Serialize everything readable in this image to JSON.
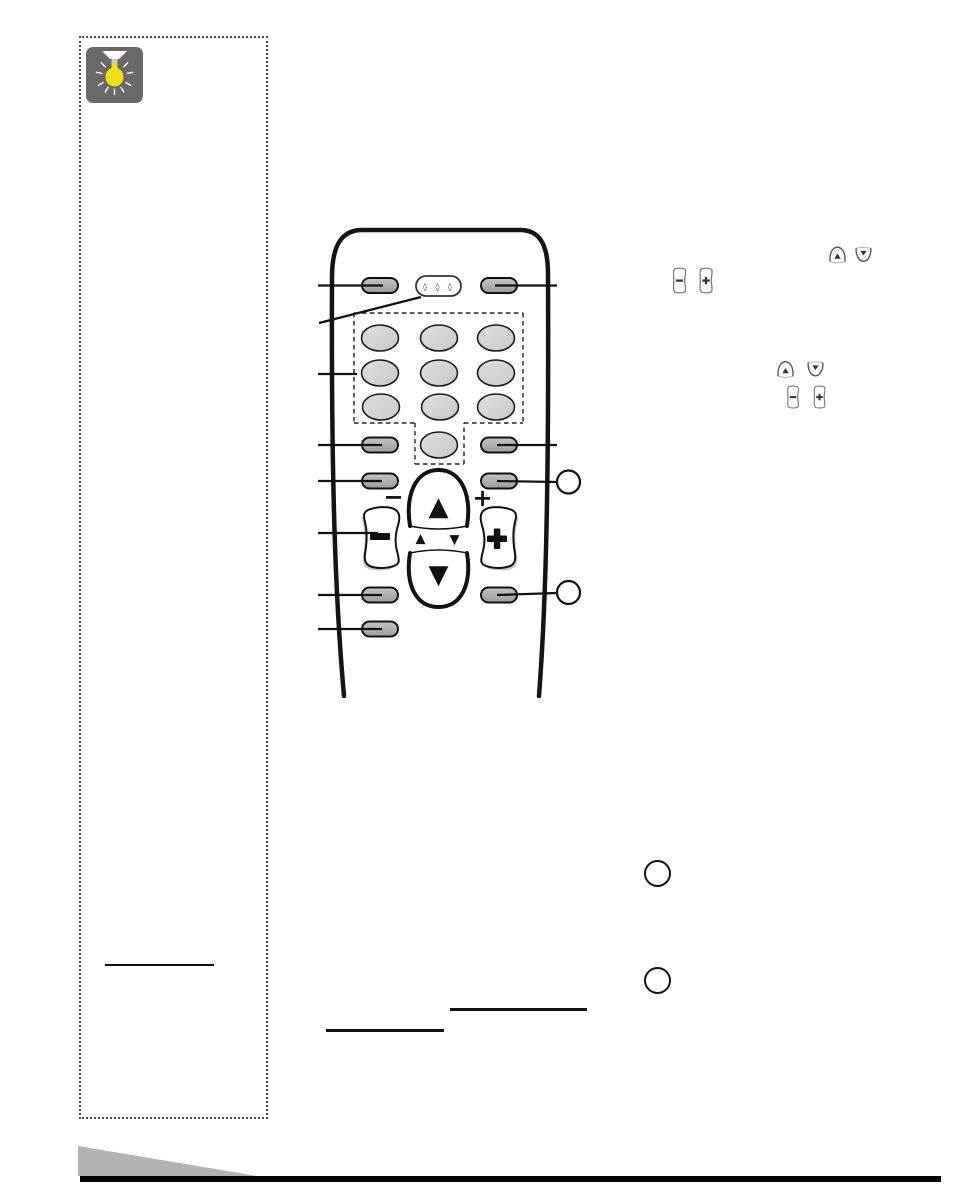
{
  "page": {
    "background_color": "#ffffff",
    "footer_bar_color": "#000000",
    "footer_triangle_color": "#b3b3b3"
  },
  "tip_sidebar": {
    "icon": "lightbulb-icon",
    "icon_background_color": "#696969",
    "bulb_color": "#f2e011",
    "has_divider_rule": true
  },
  "remote_diagram": {
    "display_dots_glyph": "◊ ◊ ◊",
    "volume_minus_hint": "−",
    "volume_plus_hint": "+",
    "minus_glyph": "−",
    "plus_glyph": "+",
    "channel_up_glyph": "▲",
    "channel_down_glyph": "▼",
    "small_up_glyph": "▲",
    "small_down_glyph": "▼",
    "keypad_button_count": 10,
    "left_side_button_count": 6,
    "right_side_button_count": 4,
    "callout_circle_count": 2,
    "body_outline_color": "#141414",
    "side_button_fill": "#b0b0b0",
    "keypad_button_fill": "#d6d6d6"
  },
  "inline_icons": {
    "group_1": [
      "channel-up-mini-icon",
      "channel-down-mini-icon"
    ],
    "group_2": [
      "volume-minus-mini-icon",
      "volume-plus-mini-icon"
    ],
    "group_3": [
      "channel-up-mini-icon",
      "channel-down-mini-icon"
    ],
    "group_4": [
      "volume-minus-mini-icon",
      "volume-plus-mini-icon"
    ],
    "minus_glyph": "−",
    "plus_glyph": "+"
  },
  "annotations": {
    "step_circle_count": 2,
    "blank_underline_count": 3
  }
}
